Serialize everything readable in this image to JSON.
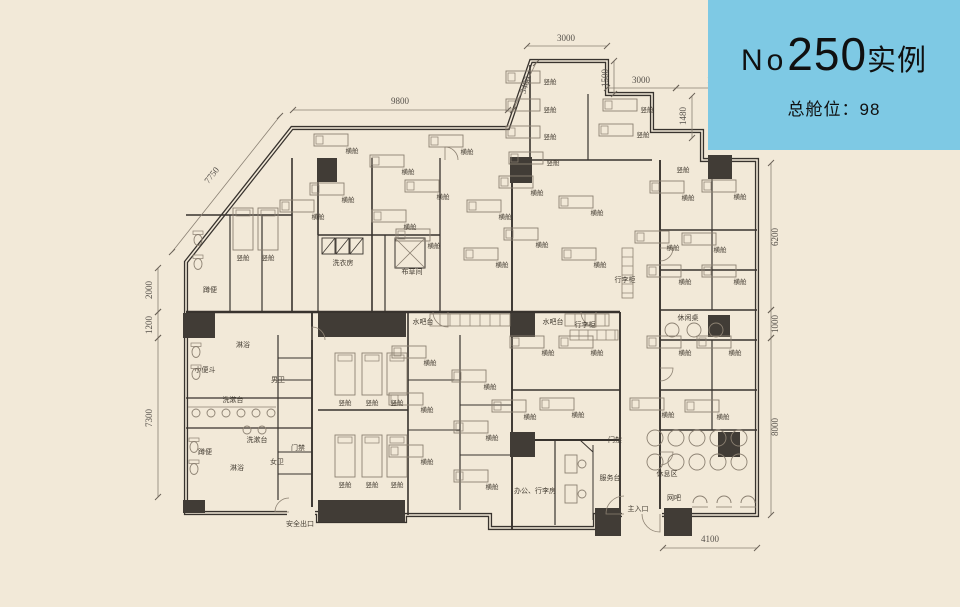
{
  "panel": {
    "no_prefix": "No",
    "number": "250",
    "suffix": "实例",
    "capacity": "总舱位：98",
    "bg_color": "#7ec9e4",
    "text_color": "#101010"
  },
  "colors": {
    "background": "#f2e9d8",
    "wall": "#38332e",
    "column_fill": "#413c36",
    "thin_line": "#8c8172",
    "label_text": "#453e34",
    "dim_text": "#55504a"
  },
  "plan": {
    "room_labels": [
      {
        "t": "横舱",
        "x": 352,
        "y": 151
      },
      {
        "t": "横舱",
        "x": 408,
        "y": 172
      },
      {
        "t": "横舱",
        "x": 348,
        "y": 200
      },
      {
        "t": "横舱",
        "x": 318,
        "y": 217
      },
      {
        "t": "横舱",
        "x": 410,
        "y": 227
      },
      {
        "t": "横舱",
        "x": 467,
        "y": 152
      },
      {
        "t": "横舱",
        "x": 443,
        "y": 197
      },
      {
        "t": "横舱",
        "x": 434,
        "y": 246
      },
      {
        "t": "横舱",
        "x": 505,
        "y": 217
      },
      {
        "t": "横舱",
        "x": 502,
        "y": 265
      },
      {
        "t": "横舱",
        "x": 537,
        "y": 193
      },
      {
        "t": "横舱",
        "x": 542,
        "y": 245
      },
      {
        "t": "横舱",
        "x": 597,
        "y": 213
      },
      {
        "t": "横舱",
        "x": 600,
        "y": 265
      },
      {
        "t": "横舱",
        "x": 688,
        "y": 198
      },
      {
        "t": "横舱",
        "x": 740,
        "y": 197
      },
      {
        "t": "横舱",
        "x": 673,
        "y": 248
      },
      {
        "t": "横舱",
        "x": 720,
        "y": 250
      },
      {
        "t": "横舱",
        "x": 685,
        "y": 282
      },
      {
        "t": "横舱",
        "x": 740,
        "y": 282
      },
      {
        "t": "横舱",
        "x": 685,
        "y": 353
      },
      {
        "t": "横舱",
        "x": 735,
        "y": 353
      },
      {
        "t": "横舱",
        "x": 668,
        "y": 415
      },
      {
        "t": "横舱",
        "x": 723,
        "y": 417
      },
      {
        "t": "横舱",
        "x": 548,
        "y": 353
      },
      {
        "t": "横舱",
        "x": 597,
        "y": 353
      },
      {
        "t": "横舱",
        "x": 530,
        "y": 417
      },
      {
        "t": "横舱",
        "x": 578,
        "y": 415
      },
      {
        "t": "横舱",
        "x": 430,
        "y": 363
      },
      {
        "t": "横舱",
        "x": 490,
        "y": 387
      },
      {
        "t": "横舱",
        "x": 427,
        "y": 410
      },
      {
        "t": "横舱",
        "x": 492,
        "y": 438
      },
      {
        "t": "横舱",
        "x": 427,
        "y": 462
      },
      {
        "t": "横舱",
        "x": 492,
        "y": 487
      },
      {
        "t": "竖舱",
        "x": 550,
        "y": 82
      },
      {
        "t": "竖舱",
        "x": 550,
        "y": 110
      },
      {
        "t": "竖舱",
        "x": 550,
        "y": 137
      },
      {
        "t": "竖舱",
        "x": 553,
        "y": 163
      },
      {
        "t": "竖舱",
        "x": 647,
        "y": 110
      },
      {
        "t": "竖舱",
        "x": 643,
        "y": 135
      },
      {
        "t": "竖舱",
        "x": 683,
        "y": 170,
        "nb": 1
      },
      {
        "t": "竖舱",
        "x": 243,
        "y": 258
      },
      {
        "t": "竖舱",
        "x": 268,
        "y": 258
      },
      {
        "t": "竖舱",
        "x": 345,
        "y": 403
      },
      {
        "t": "竖舱",
        "x": 372,
        "y": 403
      },
      {
        "t": "竖舱",
        "x": 397,
        "y": 403
      },
      {
        "t": "竖舱",
        "x": 345,
        "y": 485
      },
      {
        "t": "竖舱",
        "x": 372,
        "y": 485
      },
      {
        "t": "竖舱",
        "x": 397,
        "y": 485
      }
    ],
    "area_labels": [
      {
        "t": "洗衣房",
        "x": 343,
        "y": 263
      },
      {
        "t": "布草间",
        "x": 412,
        "y": 272
      },
      {
        "t": "淋浴",
        "x": 243,
        "y": 345
      },
      {
        "t": "淋浴",
        "x": 237,
        "y": 468
      },
      {
        "t": "男卫",
        "x": 278,
        "y": 380
      },
      {
        "t": "小便斗",
        "x": 205,
        "y": 370
      },
      {
        "t": "蹲便",
        "x": 210,
        "y": 290
      },
      {
        "t": "蹲便",
        "x": 205,
        "y": 452
      },
      {
        "t": "洗漱台",
        "x": 233,
        "y": 400
      },
      {
        "t": "洗漱台",
        "x": 257,
        "y": 440
      },
      {
        "t": "女卫",
        "x": 277,
        "y": 462
      },
      {
        "t": "门禁",
        "x": 298,
        "y": 448
      },
      {
        "t": "门禁",
        "x": 615,
        "y": 440
      },
      {
        "t": "安全出口",
        "x": 300,
        "y": 524
      },
      {
        "t": "水吧台",
        "x": 423,
        "y": 322
      },
      {
        "t": "水吧台",
        "x": 553,
        "y": 322
      },
      {
        "t": "行李柜",
        "x": 585,
        "y": 325
      },
      {
        "t": "行李柜",
        "x": 625,
        "y": 280
      },
      {
        "t": "休闲桌",
        "x": 688,
        "y": 318
      },
      {
        "t": "办公、行李房",
        "x": 535,
        "y": 491
      },
      {
        "t": "服务台",
        "x": 610,
        "y": 478
      },
      {
        "t": "主入口",
        "x": 638,
        "y": 509
      },
      {
        "t": "休息区",
        "x": 667,
        "y": 474
      },
      {
        "t": "网吧",
        "x": 674,
        "y": 498
      }
    ],
    "dimensions": [
      {
        "t": "3000",
        "x": 566,
        "y": 41,
        "r": 0,
        "l": [
          527,
          46,
          607,
          46
        ]
      },
      {
        "t": "1500",
        "x": 608,
        "y": 78,
        "r": -90,
        "l": [
          614,
          61,
          614,
          94
        ]
      },
      {
        "t": "3000",
        "x": 641,
        "y": 83,
        "r": 0,
        "l": [
          607,
          88,
          676,
          88
        ]
      },
      {
        "t": "1905",
        "x": 716,
        "y": 83,
        "r": 0,
        "l": [
          676,
          88,
          757,
          88
        ]
      },
      {
        "t": "1480",
        "x": 686,
        "y": 116,
        "r": -90,
        "l": [
          692,
          96,
          692,
          138
        ]
      },
      {
        "t": "9800",
        "x": 400,
        "y": 104,
        "r": 0,
        "l": [
          293,
          110,
          508,
          110
        ]
      },
      {
        "t": "3480",
        "x": 528,
        "y": 86,
        "r": -71,
        "l": [
          513,
          110,
          536,
          63
        ]
      },
      {
        "t": "7750",
        "x": 214,
        "y": 177,
        "r": -52,
        "l": [
          172,
          252,
          280,
          116
        ]
      },
      {
        "t": "2000",
        "x": 152,
        "y": 290,
        "r": -90,
        "l": [
          158,
          268,
          158,
          312
        ]
      },
      {
        "t": "1200",
        "x": 152,
        "y": 325,
        "r": -90,
        "l": [
          158,
          312,
          158,
          338
        ]
      },
      {
        "t": "7300",
        "x": 152,
        "y": 418,
        "r": -90,
        "l": [
          158,
          338,
          158,
          497
        ]
      },
      {
        "t": "6200",
        "x": 778,
        "y": 237,
        "r": -90,
        "l": [
          771,
          163,
          771,
          310
        ]
      },
      {
        "t": "1000",
        "x": 778,
        "y": 324,
        "r": -90,
        "l": [
          771,
          310,
          771,
          338
        ]
      },
      {
        "t": "8000",
        "x": 778,
        "y": 427,
        "r": -90,
        "l": [
          771,
          338,
          771,
          515
        ]
      },
      {
        "t": "4100",
        "x": 710,
        "y": 542,
        "r": 0,
        "l": [
          663,
          548,
          757,
          548
        ]
      }
    ]
  }
}
